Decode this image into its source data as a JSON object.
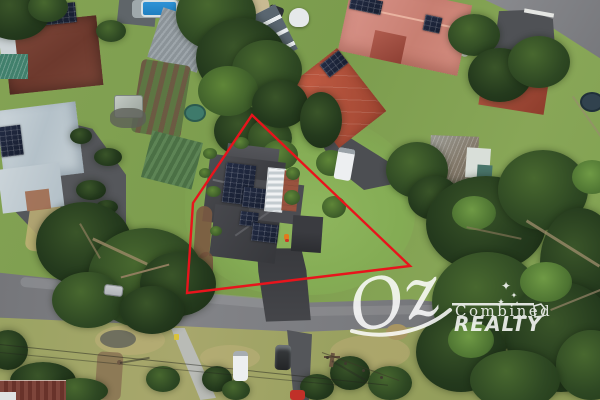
{
  "watermark": {
    "oz": "Oz",
    "combined": "Combined",
    "realty": "REALTY",
    "star_glyph": "✦",
    "color": "#ffffff"
  },
  "boundary": {
    "color": "#e8141c",
    "points": "252,115 410,266 187,293 193,203",
    "stroke_width": "2.4"
  },
  "palette": {
    "lawn": "#84a354",
    "verge_grass": "#9aa362",
    "road": "#7b7c80",
    "dark_roof": "#434448",
    "salmon_roof": "#d18a7d",
    "terracotta_roof": "#bd5b43",
    "pale_roof": "#c3cdd3",
    "tree_dark": "#2c4323",
    "solar_panel": "#1c2336",
    "pool": "#2f93d6"
  }
}
